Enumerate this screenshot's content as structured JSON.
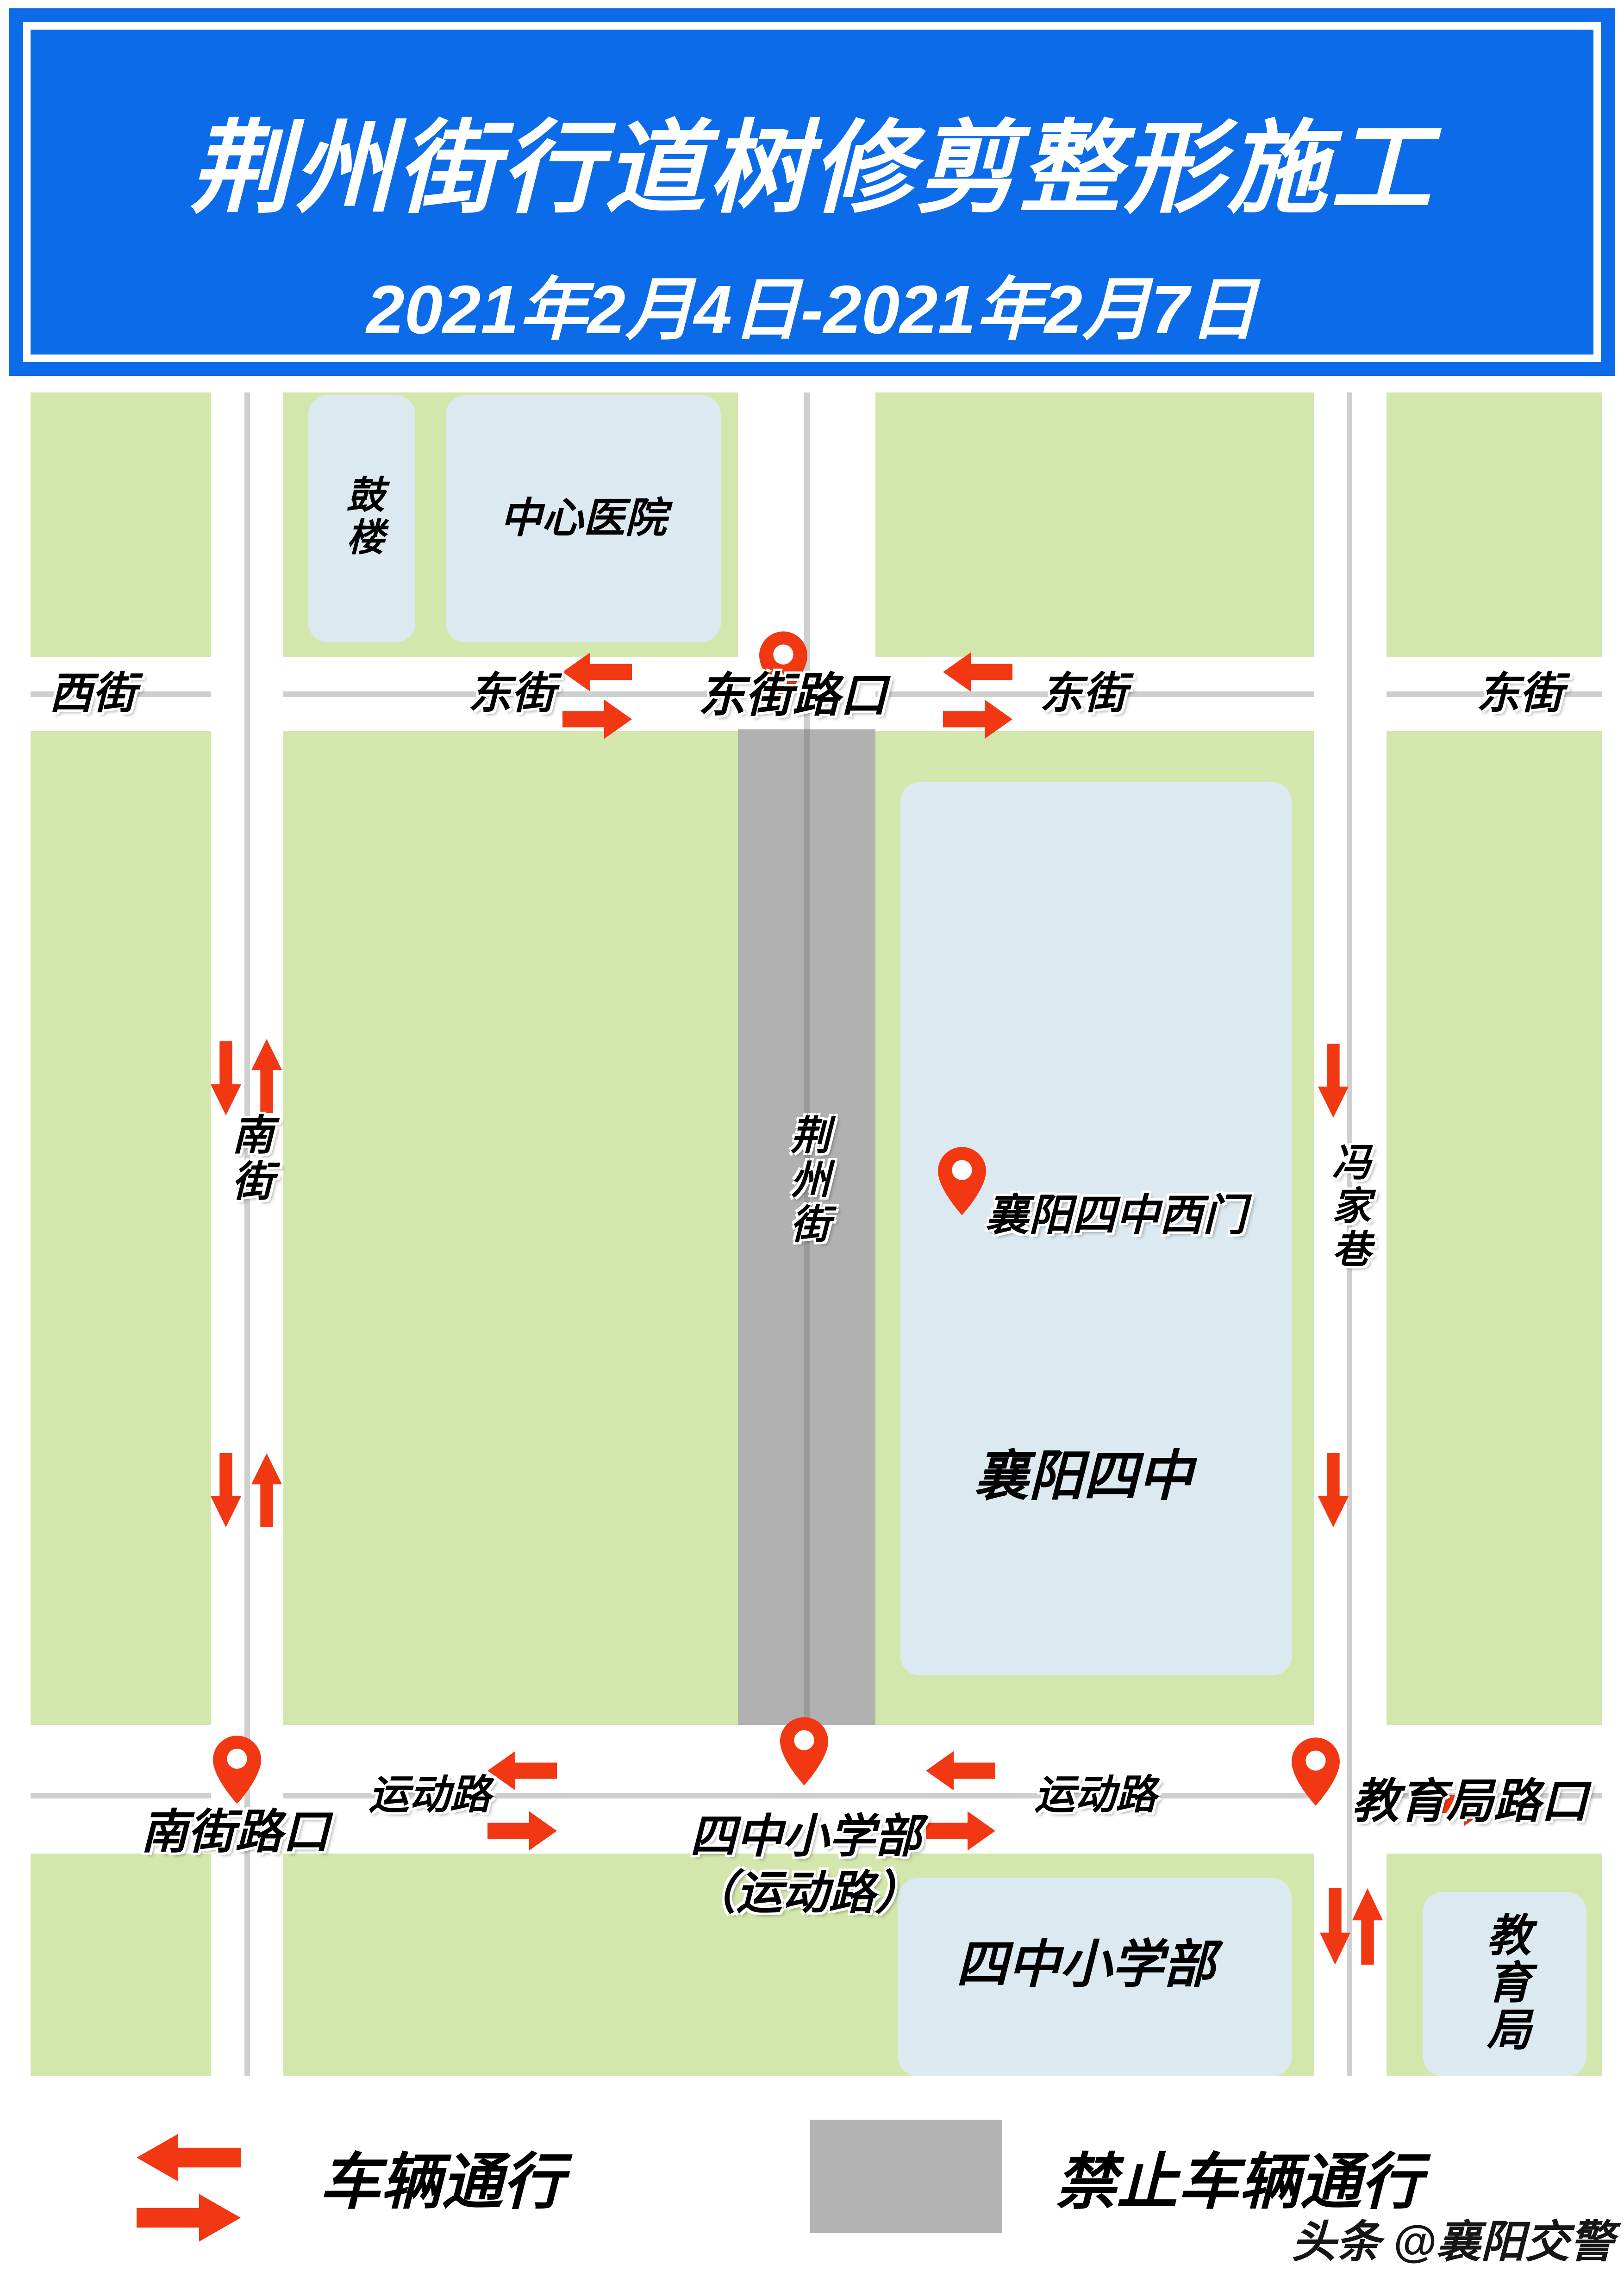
{
  "banner": {
    "title": "荆州街行道树修剪整形施工",
    "date_range": "2021年2月4日-2021年2月7日"
  },
  "streets": {
    "xijie": "西街",
    "dongjie_west": "东街",
    "dongjie_east": "东街",
    "dongjie_far": "东街",
    "nanjie": "南街",
    "jingzhou": "荆州街",
    "fengjiaxiang": "冯家巷",
    "yundong_west": "运动路",
    "yundong_east": "运动路"
  },
  "buildings": {
    "gulou": "鼓楼",
    "hospital": "中心医院",
    "no4_school": "襄阳四中",
    "primary_school": "四中小学部",
    "edu_bureau": "教育局"
  },
  "pins": {
    "dongjie_crossing": "东街路口",
    "school_west_gate": "襄阳四中西门",
    "nanjie_crossing": "南街路口",
    "primary_line1": "四中小学部",
    "primary_line2": "（运动路）",
    "edu_crossing": "教育局路口"
  },
  "legend": {
    "allow": "车辆通行",
    "forbid": "禁止车辆通行"
  },
  "watermark": "头条 @襄阳交警",
  "colors": {
    "banner_blue": "#0c6be8",
    "block_green": "#d3e7ad",
    "building_blue": "#dde9f1",
    "building_text": "#8d97a0",
    "road_centerline": "#cfcfcf",
    "closed_road_gray": "#b1b1b1",
    "closed_road_line": "#9a9a9a",
    "arrow_red": "#f23813",
    "legend_gray": "#b3b3b3"
  }
}
